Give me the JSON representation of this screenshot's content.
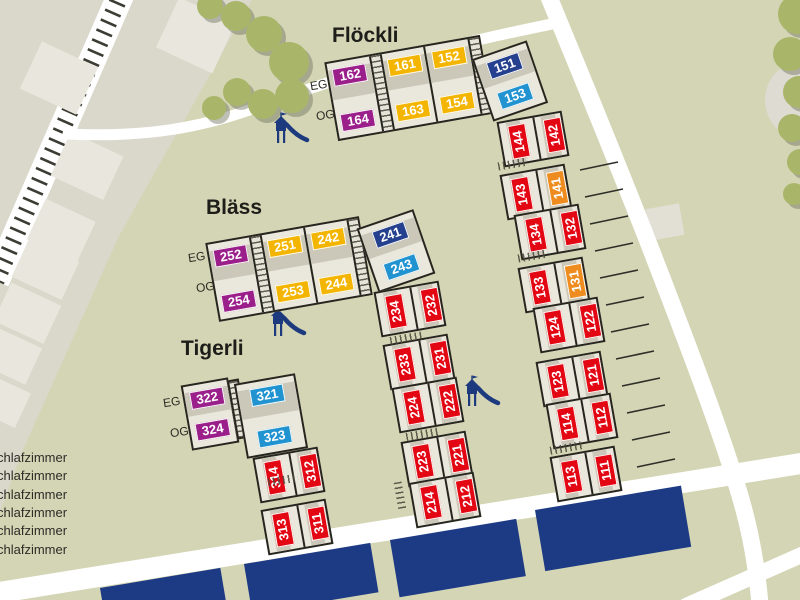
{
  "headings": {
    "floeckli": "Flöckli",
    "blaess": "Bläss",
    "tigerli": "Tigerli"
  },
  "floor_labels": {
    "eg": "EG",
    "og": "OG"
  },
  "houses": {
    "floeckli": {
      "eg": [
        "162",
        "161",
        "152"
      ],
      "og": [
        "164",
        "163",
        "154"
      ],
      "corner": {
        "eg": "151",
        "og": "153"
      }
    },
    "blaess": {
      "eg": [
        "252",
        "251",
        "242"
      ],
      "og": [
        "254",
        "253",
        "244"
      ],
      "corner": {
        "eg": "241",
        "og": "243"
      }
    },
    "tigerli": {
      "eg": [
        "322",
        "321"
      ],
      "og": [
        "324",
        "323"
      ]
    },
    "row300": [
      [
        "314",
        "312"
      ],
      [
        "313",
        "311"
      ]
    ],
    "row200": [
      [
        "234",
        "232"
      ],
      [
        "233",
        "231"
      ],
      [
        "224",
        "222"
      ],
      [
        "223",
        "221"
      ],
      [
        "214",
        "212"
      ]
    ],
    "row100": [
      [
        "144",
        "142"
      ],
      [
        "143",
        "141"
      ],
      [
        "134",
        "132"
      ],
      [
        "133",
        "131"
      ],
      [
        "124",
        "122"
      ],
      [
        "123",
        "121"
      ],
      [
        "114",
        "112"
      ],
      [
        "113",
        "111"
      ]
    ]
  },
  "legend": {
    "rows": [
      "chlafzimmer",
      "chlafzimmer",
      "chlafzimmer",
      "chlafzimmer",
      "chlafzimmer",
      "chlafzimmer"
    ]
  },
  "colors": {
    "purple": "#9b1f8b",
    "yellow": "#f4b500",
    "navy": "#24408e",
    "sky": "#2193d1",
    "red": "#e30613",
    "orange": "#ee8c1f",
    "roof_navy": "#1d3a85",
    "ground_olive": "#d4d5b4",
    "ground_gray": "#dad7cb",
    "tree_green": "#a9b66a"
  }
}
